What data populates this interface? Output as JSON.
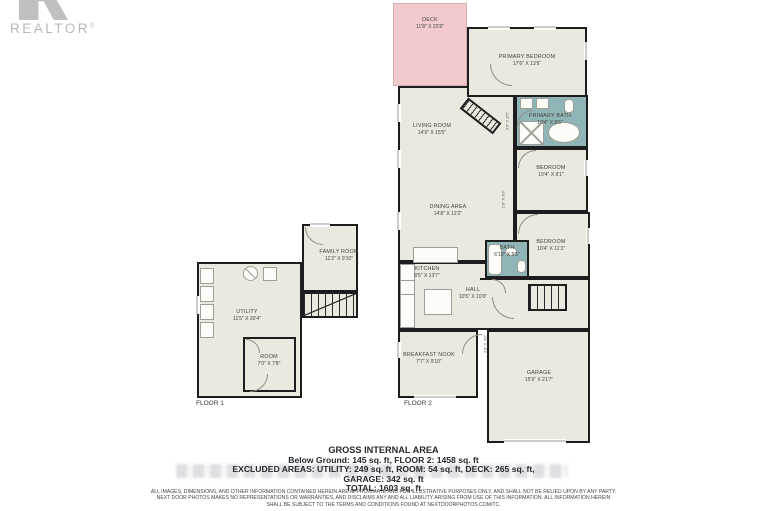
{
  "logo": {
    "brand": "REALTOR",
    "registered": "®"
  },
  "plan": {
    "floor1": {
      "label": "FLOOR 1",
      "rooms": {
        "family": {
          "name": "FAMILY ROOM",
          "dims": "11'2\" X 9'10\""
        },
        "utility": {
          "name": "UTILITY",
          "dims": "11'5\" X 20'4\""
        },
        "room": {
          "name": "ROOM",
          "dims": "7'0\" X 7'8\""
        }
      }
    },
    "floor2": {
      "label": "FLOOR 2",
      "rooms": {
        "deck": {
          "name": "DECK",
          "dims": "11'8\" X 22'8\""
        },
        "primary_bedroom": {
          "name": "PRIMARY BEDROOM",
          "dims": "17'6\" X 13'9\""
        },
        "living": {
          "name": "LIVING ROOM",
          "dims": "14'9\" X 15'5\""
        },
        "primary_bath": {
          "name": "PRIMARY BATH",
          "dims": "10'4\" X 8'6\""
        },
        "bedroom1": {
          "name": "BEDROOM",
          "dims": "10'4\" X 9'1\""
        },
        "dining": {
          "name": "DINING AREA",
          "dims": "14'8\" X 12'2\""
        },
        "bedroom2": {
          "name": "BEDROOM",
          "dims": "10'4\" X 11'3\""
        },
        "bath": {
          "name": "BATH",
          "dims": "6'10\" X 5'2\""
        },
        "kitchen": {
          "name": "KITCHEN",
          "dims": "8'5\" X 13'7\""
        },
        "hall": {
          "name": "HALL",
          "dims": "10'5\" X 10'0\""
        },
        "breakfast": {
          "name": "BREAKFAST NOOK",
          "dims": "7'7\" X 9'10\""
        },
        "garage": {
          "name": "GARAGE",
          "dims": "15'9\" X 21'7\""
        }
      },
      "closets": {
        "c1": {
          "dims": "3'6\" X 8'5\""
        },
        "c2": {
          "dims": "2'8\" X 8'3\""
        },
        "c3": {
          "dims": "3'8\" X 4'6\""
        }
      }
    }
  },
  "summary": {
    "title": "GROSS INTERNAL AREA",
    "line1": "Below Ground: 145 sq. ft, FLOOR 2: 1458 sq. ft",
    "line2": "EXCLUDED AREAS: UTILITY: 249 sq. ft, ROOM: 54 sq. ft, DECK: 265 sq. ft,",
    "line3": "GARAGE: 342 sq. ft",
    "line4": "TOTAL: 1603 sq. ft"
  },
  "disclaimer": {
    "line1": "ALL IMAGES, DIMENSIONS, AND OTHER INFORMATION CONTAINED HEREIN ARE APPROXIMATE AND FOR ILLUSTRATIVE PURPOSES ONLY, AND SHALL NOT BE RELIED UPON BY ANY PARTY.",
    "line2": "NEXT DOOR PHOTOS MAKES NO REPRESENTATIONS OR WARRANTIES, AND DISCLAIMS ANY AND ALL LIABILITY ARISING FROM USE OF THIS INFORMATION. ALL INFORMATION HEREIN",
    "line3": "SHALL BE SUBJECT TO THE TERMS AND CONDITIONS FOUND AT NEXTDOORPHOTOS.COM/TC."
  },
  "colors": {
    "wall": "#1d1d1d",
    "floor_fill": "#eae8df",
    "deck_fill": "#f2cacd",
    "bath_fill": "#8fb5b6",
    "label_text": "#45453e",
    "logo_gray": "#bdbdbd"
  }
}
